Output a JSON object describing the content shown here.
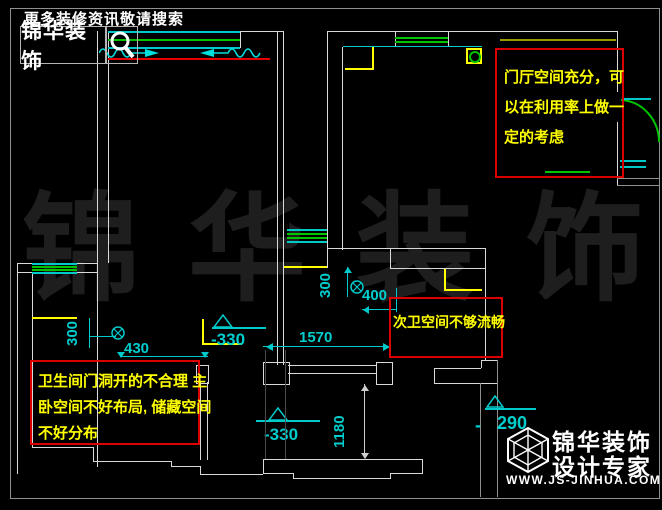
{
  "header": {
    "tagline": "更多装修资讯敬请搜索",
    "brand": "锦华装饰"
  },
  "notes": {
    "entry": {
      "lines": [
        "门厅空间充分，可",
        "以在利用率上做一",
        "定的考虑"
      ]
    },
    "bath2": {
      "lines": [
        "次卫空间不够流畅"
      ]
    },
    "master": {
      "lines": [
        "卫生间门洞开的不合理 主",
        "卧空间不好布局, 储藏空间",
        "不好分布"
      ]
    }
  },
  "dims": {
    "left_300": "300",
    "left_430": "430",
    "left_level": "-330",
    "mid_1570": "1570",
    "mid_300": "300",
    "mid_400": "400",
    "low_level": "-330",
    "low_1180": "1180",
    "right_290": "290",
    "right_dash": "-"
  },
  "watermark": {
    "c1": "锦",
    "c2": "华",
    "c3": "装",
    "c4": "饰"
  },
  "logo": {
    "name": "锦华装饰",
    "tagline": "设计专家",
    "url": "WWW.JS-JINHUA.COM"
  },
  "colors": {
    "dim_cyan": "#00c9c9",
    "wall_white": "#d9d9d9",
    "window_green": "#00c400",
    "accent_red": "#e80000",
    "note_yellow": "#ffff00",
    "note_border": "#dd0000",
    "olive": "#9a9a00",
    "watermark_grey": "#1e1e1e"
  }
}
